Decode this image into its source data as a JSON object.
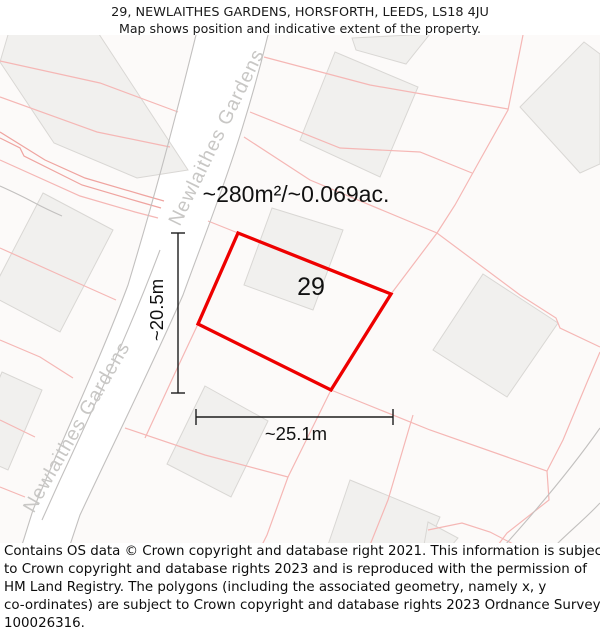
{
  "header": {
    "line1": "29, NEWLAITHES GARDENS, HORSFORTH, LEEDS, LS18 4JU",
    "line2": "Map shows position and indicative extent of the property."
  },
  "map": {
    "road_label": "Newlaithes Gardens",
    "area_label": "~280m²/~0.069ac.",
    "plot_number": "29",
    "dim_vertical_label": "~20.5m",
    "dim_horizontal_label": "~25.1m",
    "colors": {
      "plot_outline_red": "#ee0000",
      "boundary_pink": "#f5b7b5",
      "boundary_pink_dark": "#efa4a0",
      "road_edge_gray": "#c2c0bf",
      "building_fill": "#f1f0ee",
      "building_stroke": "#d9d7d4",
      "road_label_gray": "#c8c7c5",
      "dimension_black": "#1c1c1c",
      "map_background": "#fcfaf9"
    }
  },
  "footer": {
    "lines": [
      "Contains OS data © Crown copyright and database right 2021. This information is subject",
      "to Crown copyright and database rights 2023 and is reproduced with the permission of",
      "HM Land Registry. The polygons (including the associated geometry, namely x, y",
      "co-ordinates) are subject to Crown copyright and database rights 2023 Ordnance Survey",
      "100026316."
    ]
  }
}
